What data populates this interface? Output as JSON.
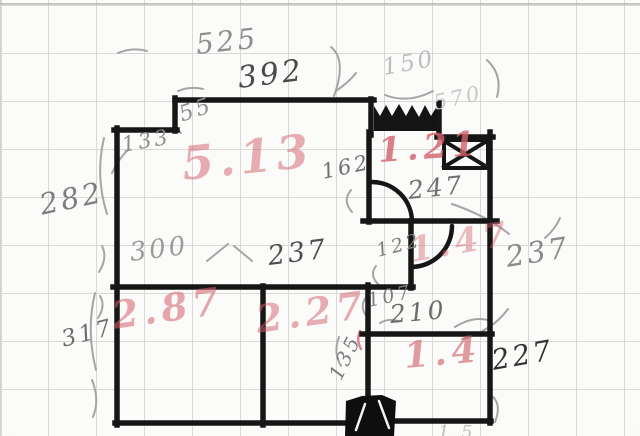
{
  "diagram_type": "hand-drawn floor plan sketch on grid paper",
  "colors": {
    "paper": "#f8f8f6",
    "grid": "#d9d9d7",
    "wall_ink": "#161616",
    "pencil": "#a5a5a5",
    "red_marker": "#d4606c"
  },
  "labels": {
    "areas": [
      {
        "t": "5.13",
        "x": 182,
        "y": 140,
        "s": 46,
        "r": -6,
        "o": 0.5
      },
      {
        "t": "1.21",
        "x": 378,
        "y": 134,
        "s": 34,
        "r": -4,
        "o": 0.8
      },
      {
        "t": "1.47",
        "x": 410,
        "y": 234,
        "s": 34,
        "r": -10,
        "o": 0.42
      },
      {
        "t": "2.87",
        "x": 112,
        "y": 296,
        "s": 38,
        "r": -8,
        "o": 0.55
      },
      {
        "t": "2.27",
        "x": 256,
        "y": 300,
        "s": 38,
        "r": -8,
        "o": 0.5
      },
      {
        "t": "1.4",
        "x": 404,
        "y": 338,
        "s": 36,
        "r": -5,
        "o": 0.62
      }
    ],
    "dimensions": [
      {
        "t": "525",
        "x": 196,
        "y": 30,
        "s": 28,
        "r": -6,
        "c": "#8d8d8d"
      },
      {
        "t": "392",
        "x": 238,
        "y": 63,
        "s": 30,
        "r": -7,
        "c": "#4a4a4a"
      },
      {
        "t": "55",
        "x": 180,
        "y": 104,
        "s": 22,
        "r": -18,
        "c": "#909090"
      },
      {
        "t": "133",
        "x": 122,
        "y": 134,
        "s": 21,
        "r": -10,
        "c": "#8d8d8d"
      },
      {
        "t": "150",
        "x": 383,
        "y": 56,
        "s": 23,
        "r": -10,
        "c": "#bdbdbd"
      },
      {
        "t": "570",
        "x": 434,
        "y": 92,
        "s": 21,
        "r": -12,
        "c": "#c9c9c9"
      },
      {
        "t": "282",
        "x": 40,
        "y": 190,
        "s": 29,
        "r": -12,
        "c": "#7d7d7d"
      },
      {
        "t": "162",
        "x": 322,
        "y": 161,
        "s": 21,
        "r": -12,
        "c": "#6f6f6f"
      },
      {
        "t": "247",
        "x": 408,
        "y": 178,
        "s": 25,
        "r": -6,
        "c": "#6f6f6f"
      },
      {
        "t": "122",
        "x": 377,
        "y": 242,
        "s": 19,
        "r": -14,
        "c": "#7c7c7c"
      },
      {
        "t": "237",
        "x": 506,
        "y": 242,
        "s": 29,
        "r": -9,
        "c": "#8a8a8a"
      },
      {
        "t": "300",
        "x": 130,
        "y": 240,
        "s": 26,
        "r": -7,
        "c": "#9b9b9b"
      },
      {
        "t": "237",
        "x": 268,
        "y": 243,
        "s": 27,
        "r": -7,
        "c": "#4f4f4f"
      },
      {
        "t": "107",
        "x": 368,
        "y": 292,
        "s": 19,
        "r": -12,
        "c": "#7c7c7c"
      },
      {
        "t": "210",
        "x": 390,
        "y": 302,
        "s": 25,
        "r": -5,
        "c": "#6b6b6b"
      },
      {
        "t": "317",
        "x": 62,
        "y": 328,
        "s": 23,
        "r": -14,
        "c": "#6f6f6f"
      },
      {
        "t": "135",
        "x": 335,
        "y": 368,
        "s": 20,
        "r": -64,
        "c": "#7c7c7c"
      },
      {
        "t": "227",
        "x": 492,
        "y": 346,
        "s": 28,
        "r": -10,
        "c": "#333333"
      },
      {
        "t": "1.5",
        "x": 438,
        "y": 424,
        "s": 18,
        "r": 0,
        "c": "#bfbfbf"
      }
    ]
  },
  "sketch": {
    "walls": [
      {
        "x1": 175,
        "y1": 100,
        "x2": 374,
        "y2": 100,
        "n": "outer-wall-top"
      },
      {
        "x1": 175,
        "y1": 98,
        "x2": 175,
        "y2": 131,
        "n": "outer-wall-step-vertical"
      },
      {
        "x1": 114,
        "y1": 130,
        "x2": 177,
        "y2": 130,
        "n": "outer-wall-step-horizontal"
      },
      {
        "x1": 117,
        "y1": 128,
        "x2": 117,
        "y2": 425,
        "n": "outer-wall-left"
      },
      {
        "x1": 115,
        "y1": 423,
        "x2": 347,
        "y2": 423,
        "n": "outer-wall-bottom-left"
      },
      {
        "x1": 394,
        "y1": 421,
        "x2": 491,
        "y2": 421,
        "n": "outer-wall-bottom-right"
      },
      {
        "x1": 490,
        "y1": 132,
        "x2": 490,
        "y2": 423,
        "n": "outer-wall-right"
      },
      {
        "x1": 263,
        "y1": 286,
        "x2": 263,
        "y2": 425,
        "n": "interior-wall-vertical-mid"
      },
      {
        "x1": 113,
        "y1": 287,
        "x2": 413,
        "y2": 287,
        "n": "interior-wall-horizontal-long"
      },
      {
        "x1": 368,
        "y1": 285,
        "x2": 368,
        "y2": 402,
        "n": "interior-wall-vertical-right"
      },
      {
        "x1": 362,
        "y1": 334,
        "x2": 492,
        "y2": 334,
        "n": "interior-wall-horizontal-210"
      },
      {
        "x1": 369,
        "y1": 132,
        "x2": 369,
        "y2": 222,
        "n": "room-topright-left-wall"
      },
      {
        "x1": 363,
        "y1": 221,
        "x2": 497,
        "y2": 221,
        "n": "room-topright-bottom-wall"
      },
      {
        "x1": 371,
        "y1": 99,
        "x2": 371,
        "y2": 135,
        "n": "window-left-stub"
      },
      {
        "x1": 439,
        "y1": 103,
        "x2": 439,
        "y2": 136,
        "n": "window-right-stub"
      },
      {
        "x1": 437,
        "y1": 137,
        "x2": 493,
        "y2": 137,
        "n": "outer-wall-top-right"
      },
      {
        "x1": 411,
        "y1": 221,
        "x2": 411,
        "y2": 288,
        "n": "door-wall-vertical"
      },
      {
        "x1": 444,
        "y1": 140,
        "x2": 488,
        "y2": 140,
        "w": 4,
        "n": "shaft-box-top"
      },
      {
        "x1": 444,
        "y1": 168,
        "x2": 488,
        "y2": 168,
        "w": 4,
        "n": "shaft-box-bottom"
      },
      {
        "x1": 444,
        "y1": 140,
        "x2": 444,
        "y2": 168,
        "w": 4,
        "n": "shaft-box-left"
      },
      {
        "x1": 488,
        "y1": 140,
        "x2": 488,
        "y2": 168,
        "w": 4,
        "n": "shaft-box-right"
      },
      {
        "x1": 444,
        "y1": 141,
        "x2": 487,
        "y2": 167,
        "w": 4,
        "n": "shaft-box-diagonal-1"
      },
      {
        "x1": 444,
        "y1": 167,
        "x2": 487,
        "y2": 141,
        "w": 4,
        "n": "shaft-box-diagonal-2"
      }
    ],
    "door_arcs": [
      {
        "d": "M 372,182 A 40,40 0 0 1 412,222",
        "n": "door-swing-top"
      },
      {
        "d": "M 452,226 A 41,41 0 0 1 411,267",
        "n": "door-swing-middle"
      }
    ],
    "solids": [
      {
        "d": "M374,106 L380,116 L386,105 L392,116 L399,104 L406,116 L412,105 L419,117 L425,105 L431,116 L437,106 L437,131 L374,131 Z",
        "f": "#141414",
        "n": "window-scribble"
      },
      {
        "d": "M346,401 L362,396 L382,395 L396,401 L394,436 L345,436 Z",
        "f": "#0e0e0e",
        "n": "entry-door-blob"
      }
    ],
    "pencil_marks": [
      {
        "d": "M1,0 L1,436",
        "c": "#cfcfcd",
        "w": 1.5,
        "n": "photo-left-edge"
      },
      {
        "d": "M0,4 L640,4",
        "c": "#b4b4b4",
        "w": 1.5,
        "n": "page-top-line"
      },
      {
        "d": "M104,138 Q95,176 107,214",
        "n": "bracket-282"
      },
      {
        "d": "M102,246 Q108,258 99,272",
        "n": "squiggle-left-1"
      },
      {
        "d": "M100,296 Q106,306 98,318",
        "n": "squiggle-left-2"
      },
      {
        "d": "M118,53 Q132,47 147,51",
        "n": "dash-525"
      },
      {
        "d": "M178,91 Q190,86 203,89",
        "n": "dash-392-left"
      },
      {
        "d": "M336,91 Q349,82 356,73",
        "n": "curl-392-right"
      },
      {
        "d": "M334,96 Q347,60 331,47",
        "n": "curve-window-left"
      },
      {
        "d": "M487,60 Q503,75 497,97",
        "n": "curve-top-right"
      },
      {
        "d": "M385,95 Q408,104 433,91",
        "n": "underline-150"
      },
      {
        "d": "M351,190 Q342,201 352,212",
        "n": "bracket-162"
      },
      {
        "d": "M452,204 Q487,216 509,234",
        "n": "leader-247"
      },
      {
        "d": "M545,238 Q556,228 560,218",
        "n": "curl-237-upper"
      },
      {
        "d": "M462,339 Q492,331 508,309",
        "n": "curve-right-junction"
      },
      {
        "d": "M380,323 Q389,318 398,321",
        "n": "dash-210"
      },
      {
        "d": "M455,327 Q474,315 491,321",
        "n": "curve-210-right"
      },
      {
        "d": "M339,337 Q333,352 341,366",
        "n": "squiggle-135"
      },
      {
        "d": "M95,293 Q86,330 96,370",
        "n": "bracket-317-upper"
      },
      {
        "d": "M92,380 Q100,400 93,417",
        "n": "bracket-317-lower"
      },
      {
        "d": "M207,261 L228,244",
        "n": "slash-300-1"
      },
      {
        "d": "M234,246 L252,261",
        "n": "slash-300-2"
      },
      {
        "d": "M376,266 Q369,275 378,284",
        "n": "curl-122"
      },
      {
        "d": "M366,297 Q359,307 367,317",
        "n": "curl-107"
      },
      {
        "d": "M489,394 Q503,402 495,422",
        "n": "curl-bottom-right"
      },
      {
        "d": "M177,107 Q170,121 181,133",
        "n": "tick-55"
      },
      {
        "d": "M112,173 Q119,158 129,149",
        "n": "arrow-133"
      },
      {
        "d": "M360,331 Q356,340 361,349",
        "c": "#dc8890",
        "w": 2.5,
        "n": "red-tick"
      }
    ],
    "overlays": [
      {
        "d": "M365,404 L356,430",
        "c": "#f2f2f0",
        "w": 2.5,
        "n": "blob-highlight-1"
      },
      {
        "d": "M379,401 L389,428",
        "c": "#f2f2f0",
        "w": 2.5,
        "n": "blob-highlight-2"
      }
    ]
  }
}
